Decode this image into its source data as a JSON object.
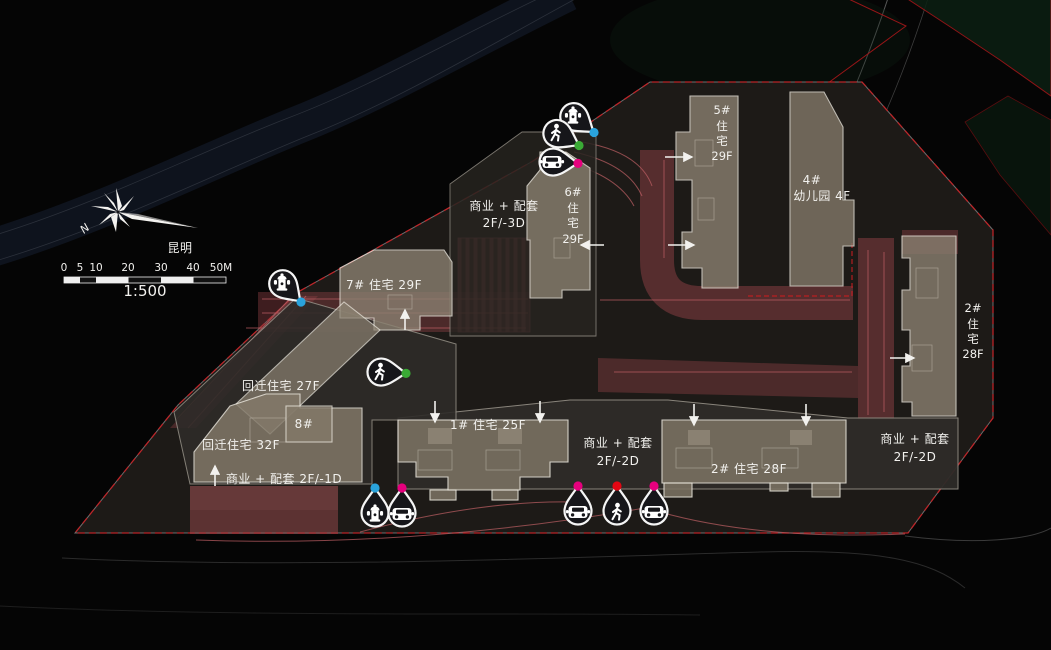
{
  "meta": {
    "north_label": "N",
    "city": "昆明",
    "scale_ratio": "1:500",
    "scalebar_ticks": [
      "0",
      "5",
      "10",
      "20",
      "30",
      "40",
      "50M"
    ]
  },
  "buildings": {
    "b5": {
      "no": "5#",
      "l1": "住",
      "l2": "宅",
      "floors": "29F"
    },
    "b6": {
      "no": "6#",
      "l1": "住",
      "l2": "宅",
      "floors": "29F"
    },
    "b2e": {
      "no": "2#",
      "l1": "住",
      "l2": "宅",
      "floors": "28F"
    },
    "b4": {
      "no": "4#",
      "label": "幼儿园 4F"
    },
    "b7": {
      "label": "7#  住宅 29F"
    },
    "b1": {
      "label": "1#  住宅 25F"
    },
    "b2s": {
      "label": "2#  住宅 28F"
    },
    "hq27": {
      "label": "回迁住宅 27F"
    },
    "hq32": {
      "label": "回迁住宅 32F"
    },
    "b8": {
      "label": "8#"
    }
  },
  "commercial": {
    "top": {
      "l1": "商业 + 配套",
      "l2": "2F/-3D"
    },
    "mid": {
      "l1": "商业 + 配套",
      "l2": "2F/-2D"
    },
    "right": {
      "l1": "商业 + 配套",
      "l2": "2F/-2D"
    },
    "left": {
      "label": "商业 + 配套 2F/-1D"
    }
  },
  "entrances": {
    "icons": [
      "fire-hydrant",
      "pedestrian",
      "car"
    ],
    "dot_colors": {
      "fire": "#2aa3dc",
      "pedestrian": "#3aaa35",
      "vehicle": "#e6007e",
      "pedestrian_main": "#e30613"
    }
  },
  "colors": {
    "fire_lane": "#8f4045",
    "boundary_red": "#c41e22",
    "building_fill": "#8a8070",
    "building_fill_dark": "#7b7263",
    "site_fill": "#1d1a17"
  }
}
